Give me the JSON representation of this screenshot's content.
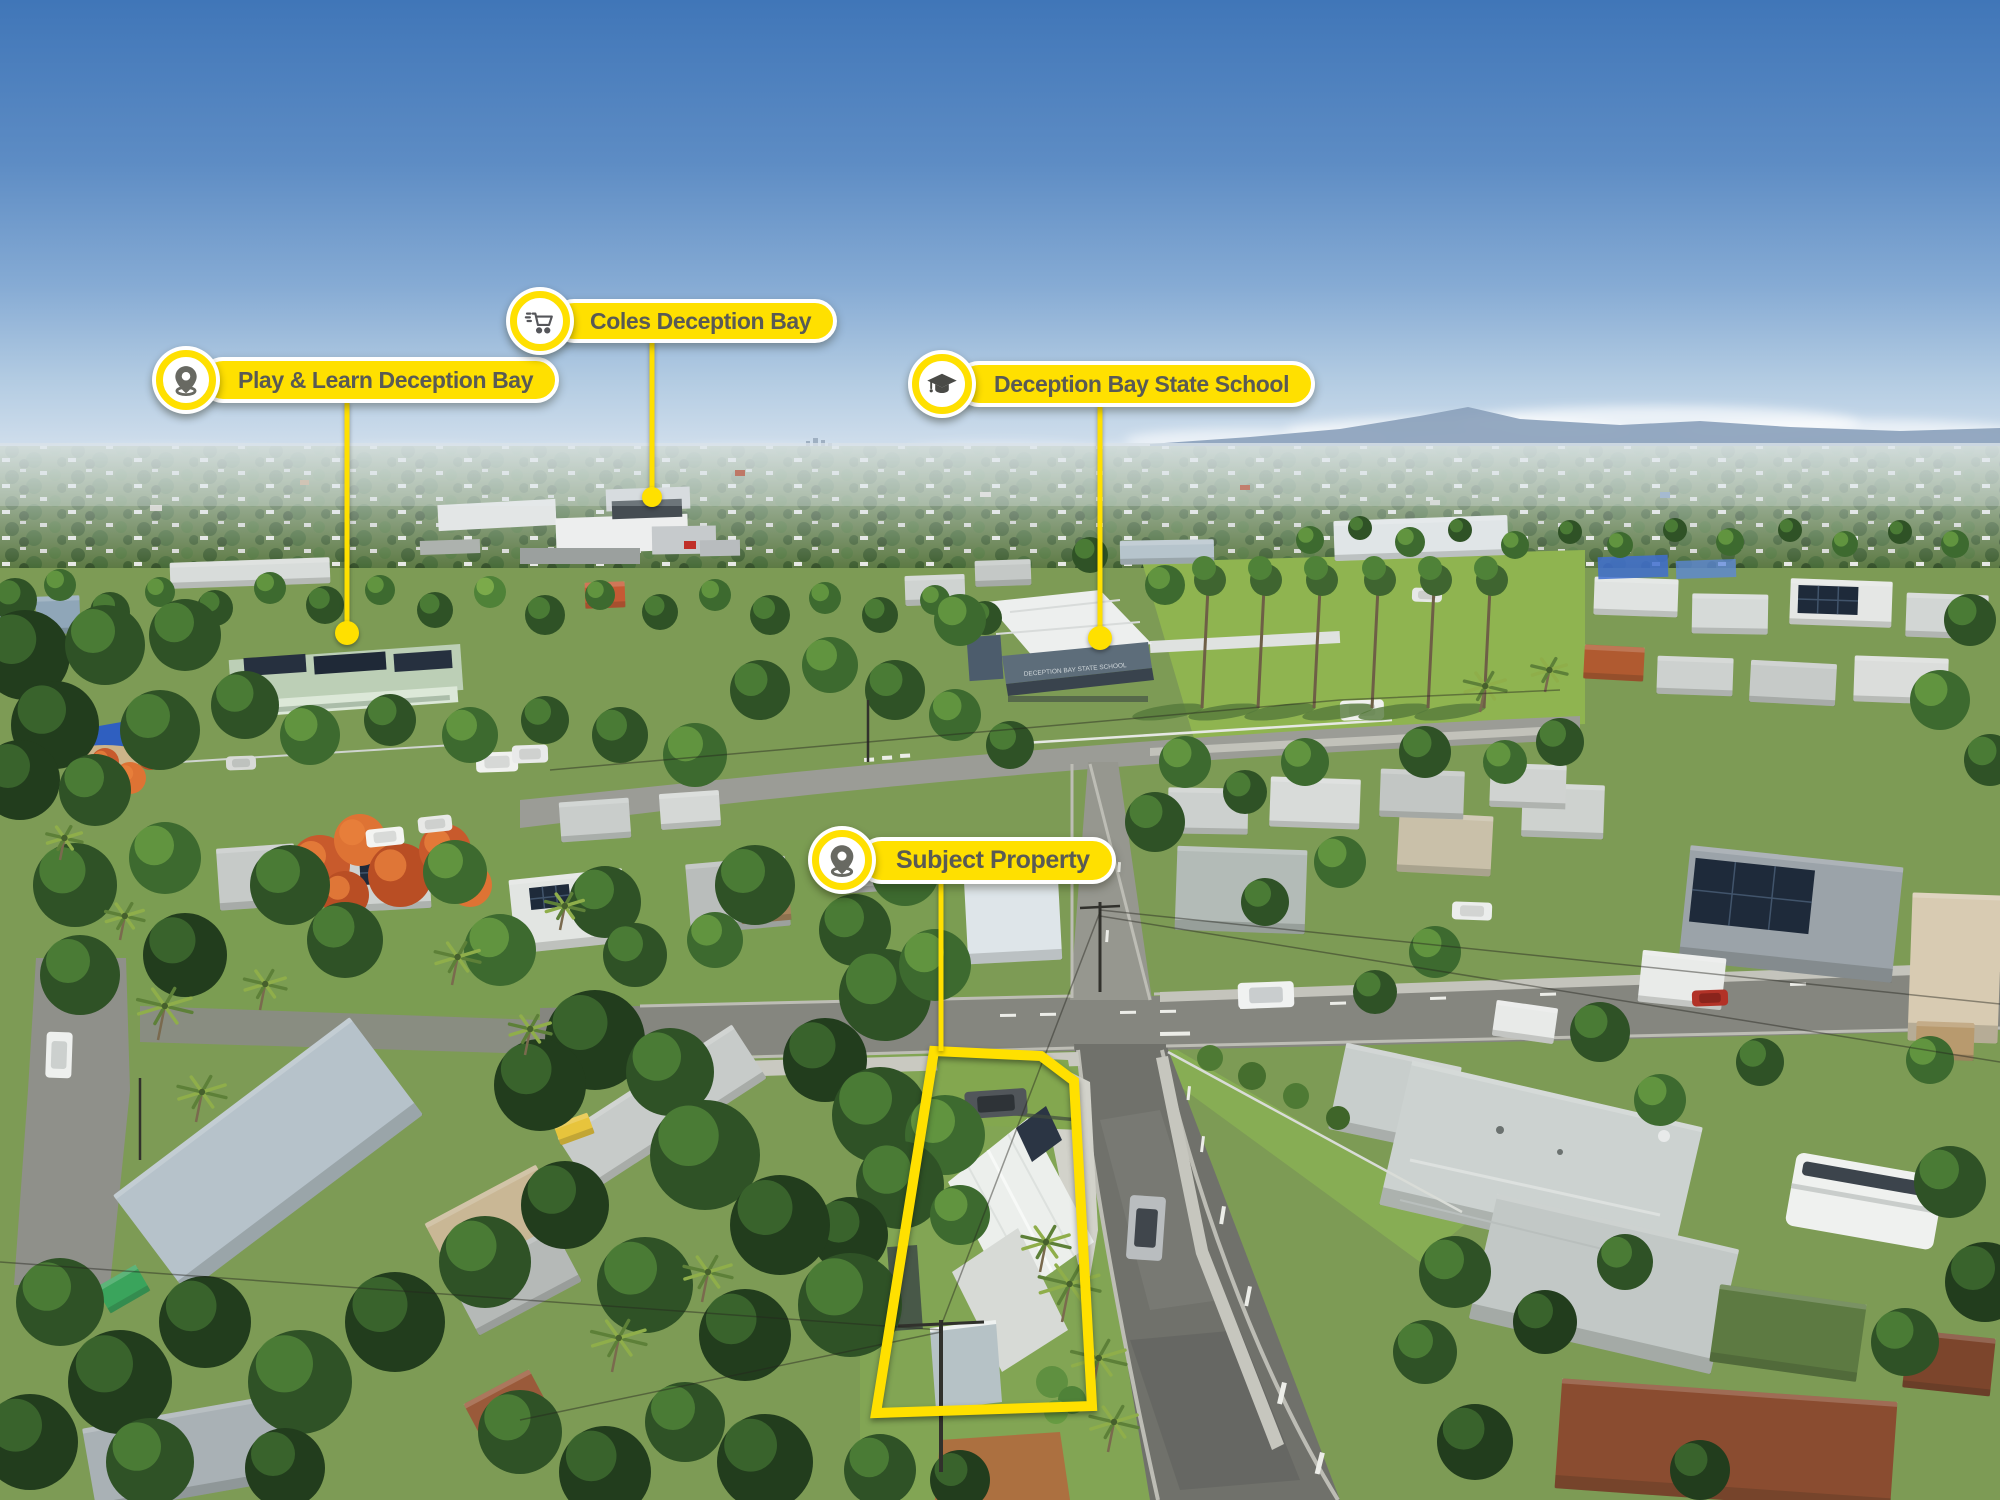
{
  "annotations": {
    "pills": [
      {
        "label": "Play & Learn Deception Bay",
        "icon": "map-pin"
      },
      {
        "label": "Coles Deception Bay",
        "icon": "shopping-cart"
      },
      {
        "label": "Deception Bay State School",
        "icon": "graduation-cap"
      },
      {
        "label": "Subject Property",
        "icon": "map-pin"
      }
    ],
    "property_outline": "subject property boundary"
  },
  "scene": {
    "school_sign": "DECEPTION BAY STATE SCHOOL",
    "description": "aerial drone photo of Deception Bay suburb"
  },
  "colors": {
    "accent_yellow": "#ffe000",
    "pill_text": "#595a55",
    "pill_border": "#ffffff"
  }
}
